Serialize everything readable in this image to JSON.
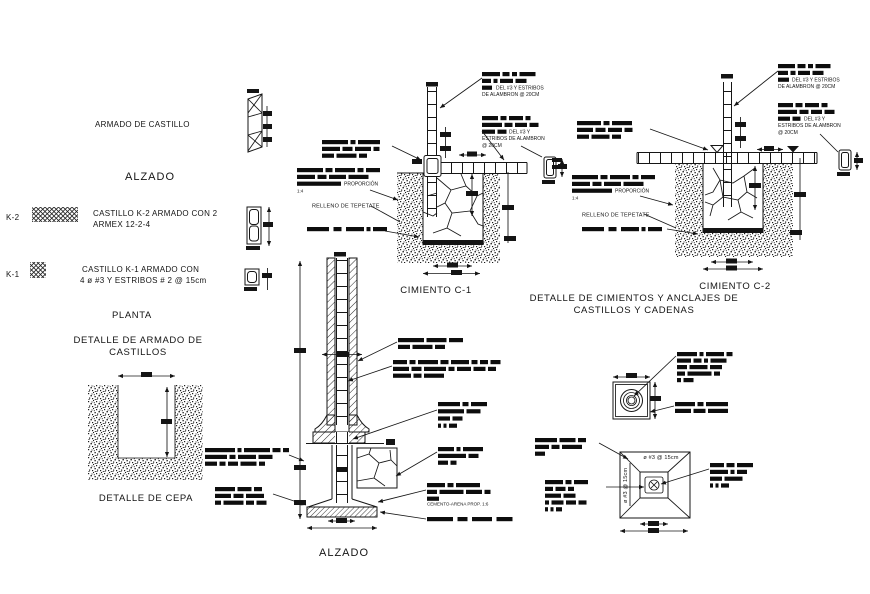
{
  "page": {
    "bg": "#ffffff",
    "ink": "#161616"
  },
  "legend": {
    "armado_title": "ARMADO DE CASTILLO",
    "alzado_label": "ALZADO",
    "k2_tag": "K-2",
    "k2_line1": "CASTILLO K-2 ARMADO CON 2",
    "k2_line2": "ARMEX 12-2-4",
    "k1_tag": "K-1",
    "k1_line1": "CASTILLO K-1 ARMADO CON",
    "k1_line2": "4 ø #3 Y ESTRIBOS # 2 @ 15cm",
    "planta_label": "PLANTA",
    "detalle_armado_line1": "DETALLE DE ARMADO DE",
    "detalle_armado_line2": "CASTILLOS"
  },
  "cepa": {
    "caption": "DETALLE DE CEPA"
  },
  "c1": {
    "caption": "CIMIENTO  C-1",
    "ann1_line1": "DEL #3 Y ESTRIBOS",
    "ann1_line2": "DE ALAMBRON @ 20CM",
    "ann2_line1": "DEL #3 Y",
    "ann2_line2": "ESTRIBOS DE ALAMBRON",
    "ann2_line3": "@ 20CM",
    "proporcion": "PROPORCIÓN",
    "ratio": "1:4",
    "relleno": "RELLENO DE TEPETATE"
  },
  "c2": {
    "caption": "CIMIENTO  C-2",
    "ann1_line1": "DEL #3 Y ESTRIBOS",
    "ann1_line2": "DE ALAMBRON @ 20CM",
    "ann2_line1": "DEL #3 Y",
    "ann2_line2": "ESTRIBOS DE ALAMBRON",
    "ann2_line3": "@ 20CM",
    "proporcion": "PROPORCIÓN",
    "ratio": "1:4",
    "relleno": "RELLENO DE TEPETATE",
    "title_line1": "DETALLE DE CIMIENTOS Y ANCLAJES DE",
    "title_line2": "CASTILLOS Y CADENAS"
  },
  "alzado": {
    "caption": "ALZADO",
    "cemento": "CEMENTO-ARENA PROP. 1:6"
  },
  "plans": {
    "rebar_top": "ø #3 @ 15cm",
    "rebar_left": "ø #3 @ 15cm"
  }
}
